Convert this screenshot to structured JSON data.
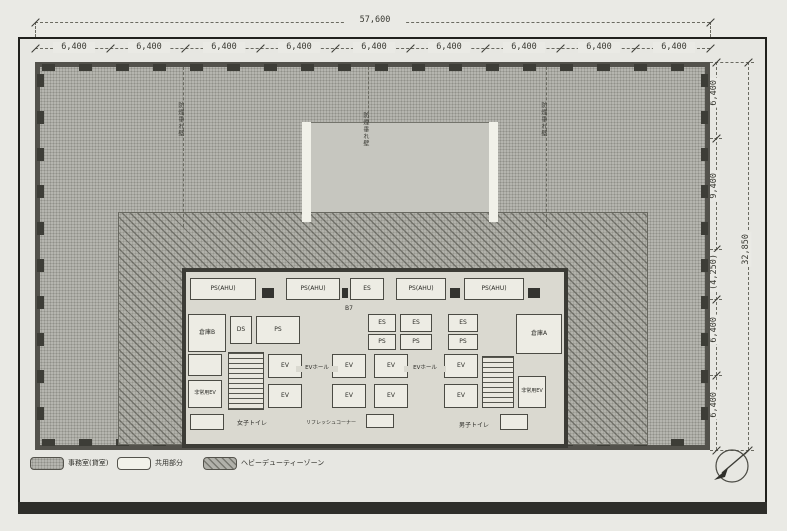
{
  "dims": {
    "top_total": "57,600",
    "top_segments": [
      "6,400",
      "6,400",
      "6,400",
      "6,400",
      "6,400",
      "6,400",
      "6,400",
      "6,400",
      "6,400"
    ],
    "right_segments": [
      "6,400",
      "9,400",
      "(4,250)",
      "6,400",
      "6,400"
    ],
    "right_total": "32,850"
  },
  "annotations": {
    "smoke_walls": [
      "防煙垂れ壁",
      "防煙垂れ壁",
      "防煙垂れ壁"
    ],
    "core_note": "B7"
  },
  "core": {
    "service_boxes": [
      "PS(AHU)",
      "PS(AHU)",
      "ES",
      "PS(AHU)",
      "PS(AHU)"
    ],
    "rooms": {
      "storage_b": "倉庫B",
      "storage_a": "倉庫A",
      "ds": "DS",
      "ps": "PS",
      "es": "ES",
      "ev": "EV",
      "fire_ev": "非常用EV",
      "ev_hall": "EVホール",
      "toilet_women": "女子トイレ",
      "toilet_men": "男子トイレ",
      "refresh_corner": "リフレッシュコーナー"
    }
  },
  "legend": {
    "items": [
      {
        "label": "事務室(貸室)",
        "swatch": "office-screen"
      },
      {
        "label": "共用部分",
        "swatch": "common-white"
      },
      {
        "label": "ヘビーデューティーゾーン",
        "swatch": "heavy-duty-hatch"
      }
    ]
  },
  "colors": {
    "office_fill": "#b5b5af",
    "hatch_fill": "#b1b1aa",
    "wall": "#3c3c36",
    "paper": "#e7e7e2"
  },
  "icons": {
    "north_arrow": "north-arrow"
  }
}
